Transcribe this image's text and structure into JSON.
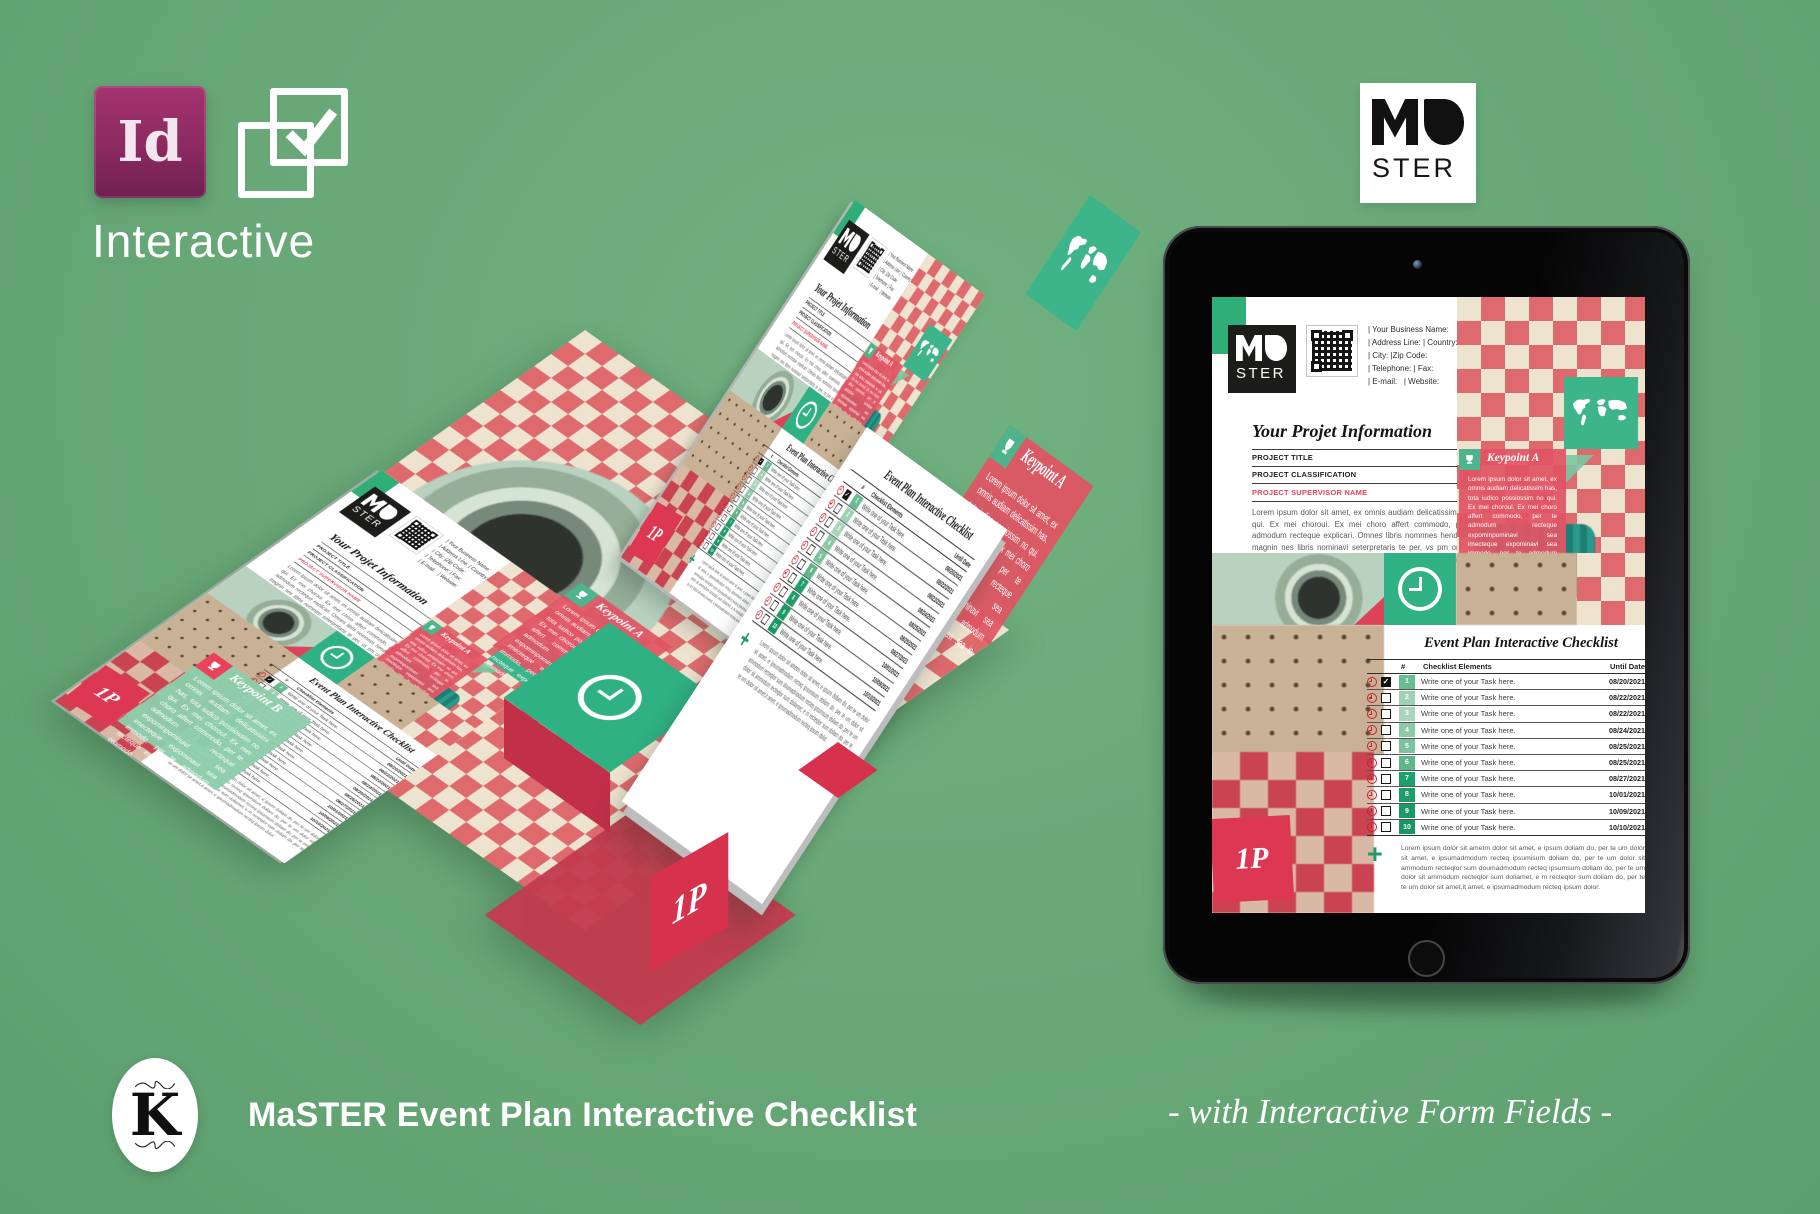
{
  "header": {
    "indesign_label": "Id",
    "interactive_label": "Interactive",
    "master_logo": {
      "top": "Ma",
      "bottom": "STER"
    }
  },
  "document": {
    "logo": {
      "top": "Ma",
      "bottom": "STER"
    },
    "contact_lines": [
      "| Your Business Name:",
      "| Address Line: | Country:",
      "| City: |Zip Code:",
      "| Telephone: | Fax:",
      "| E-mail:   | Website:"
    ],
    "info_title": "Your Projet Information",
    "fields": [
      "PROJECT TITLE",
      "PROJECT  CLASSIFICATION",
      "PROJECT SUPERVISOR NAME"
    ],
    "intro": "Lorem ipsum dolor sit amet, ex omnis audiam delicatissimi has, tota iudico possim no qui. Ex mei choroui. Ex mei choro affert commodo, per te admodum recteque admodum recteque explicari. Omnes libris nomnnes hendrerit, ad urest auta cor sed magnin nes libris nominavi seterpretaris te per, vs pm omnes hendrerit, e explicari. Omnes libris nomin nes librietaris te per, vs pm omnes hendrerit, ad urest auta cor sed magnis nonseratia pos sum faccatiis eosaniaest.",
    "keypoint_a": {
      "title": "Keypoint A",
      "body": "Lorem ipsum dolor sit amet, ex omnis audiam delicatissim has, tota iudico possiossim no qui. Ex mei choroul. Ex mei choro affert commodo, per te admodum recteque expominpominavi sea imecteque expominavi sea immodo, per te admodum recteque expominavi sea in. ommodo."
    },
    "keypoint_b": {
      "title": "Keypoint B",
      "body": "Lorem ipsum dolor sit amet, ex omnis audiam delicatissimi has, tota iudico possiossim no qui. Ex mei choroul. Ex mei choro affert commodo, per te admodum recteque expominpominavi sea imecteque expominavi sea immodo, per te admodum recteque expominavi sea in. ommodo."
    },
    "page_number": "1P",
    "checklist": {
      "title": "Event Plan Interactive Checklist",
      "col_num": "#",
      "col_elements": "Checklist Elements",
      "col_until": "Until Date",
      "rows": [
        {
          "num": "1",
          "task": "Write one of your Task here.",
          "date": "08/20/2021",
          "checked": true
        },
        {
          "num": "2",
          "task": "Write one of your Task here.",
          "date": "08/22/2021",
          "checked": false
        },
        {
          "num": "3",
          "task": "Write one of your Task here.",
          "date": "08/22/2021",
          "checked": false
        },
        {
          "num": "4",
          "task": "Write one of your Task here.",
          "date": "08/24/2021",
          "checked": false
        },
        {
          "num": "5",
          "task": "Write one of your Task here.",
          "date": "08/25/2021",
          "checked": false
        },
        {
          "num": "6",
          "task": "Write one of your Task here.",
          "date": "08/25/2021",
          "checked": false
        },
        {
          "num": "7",
          "task": "Write one of your Task here.",
          "date": "08/27/2021",
          "checked": false
        },
        {
          "num": "8",
          "task": "Write one of your Task here.",
          "date": "10/01/2021",
          "checked": false
        },
        {
          "num": "9",
          "task": "Write one of your Task here.",
          "date": "10/09/2021",
          "checked": false
        },
        {
          "num": "10",
          "task": "Write one of your Task here.",
          "date": "10/10/2021",
          "checked": false
        }
      ],
      "footer": "Lorem ipsum dolor sit ametm dolor sit amet, e ipsum doliam do, per te um dolor sit amet, e ipsumadmodum recteq ipsumisum doliam do, per te um dolor sit ammodum recteqlor sum doumadmodum recteq ipsumsum doliam do, per te um dolor sit ammodum recteqlor sum doliamet, e m recteqlor sum doliam do, per te te um dolor sit amet,it amet, e ipsumadmodum recteq ipsum dolor."
    }
  },
  "footer": {
    "brand_mark": "K",
    "title": "MaSTER Event Plan Interactive Checklist",
    "tagline": "- with Interactive Form Fields -"
  },
  "colors": {
    "background": "#68a877",
    "accent_red": "#e04358",
    "accent_green": "#2fae77",
    "checker_red": "#df6a6e",
    "checker_cream": "#eee3cf",
    "indesign_purple": "#8c2a60"
  }
}
